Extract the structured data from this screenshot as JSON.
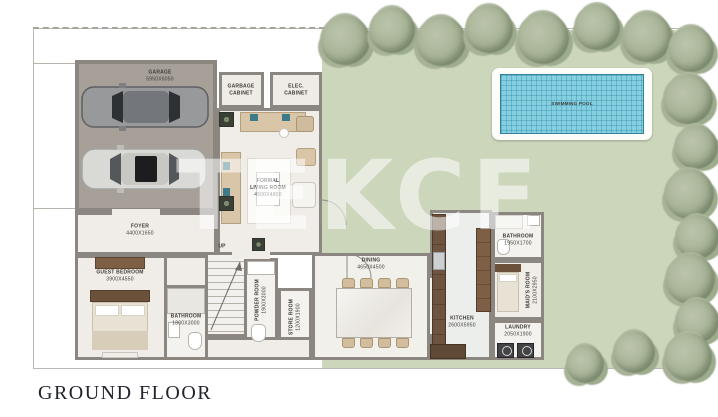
{
  "title": "GROUND FLOOR",
  "watermark": "TEKCE",
  "colors": {
    "garden_green": "#ccd6ba",
    "pool_blue": "#84d0e1",
    "wall_gray": "#8b8680",
    "garage_floor": "#a7a099",
    "interior_floor": "#f0ede8",
    "wood_brown": "#7c5f45",
    "accent_teal": "#3d7b8a"
  },
  "rooms": {
    "garage": {
      "name": "GARAGE",
      "dims": "5950X6050"
    },
    "garbage_cabinet": {
      "name": "GARBAGE",
      "name2": "CABINET"
    },
    "elec_cabinet": {
      "name": "ELEC.",
      "name2": "CABINET"
    },
    "formal_living": {
      "name": "FORMAL",
      "name2": "LIVING ROOM",
      "dims": "4500X4800"
    },
    "foyer": {
      "name": "FOYER",
      "dims": "4400X1650"
    },
    "guest_bedroom": {
      "name": "GUEST BEDROOM",
      "dims": "3900X4550"
    },
    "guest_bathroom": {
      "name": "BATHROOM",
      "dims": "1800X3000"
    },
    "stairs": {
      "name": "UP"
    },
    "powder_room": {
      "name": "POWDER ROOM",
      "dims": "1900X3000"
    },
    "store_room": {
      "name": "STORE ROOM",
      "dims": "1200X1900"
    },
    "dining": {
      "name": "DINING",
      "dims": "4650X4500"
    },
    "kitchen": {
      "name": "KITCHEN",
      "dims": "2600X5950"
    },
    "maid_bathroom": {
      "name": "BATHROOM",
      "dims": "1950X1700"
    },
    "maids_room": {
      "name": "MAID'S ROOM",
      "dims": "2100X2950"
    },
    "laundry": {
      "name": "LAUNDRY",
      "dims": "2050X1900"
    },
    "pool": {
      "name": "SWIMMING POOL"
    }
  }
}
